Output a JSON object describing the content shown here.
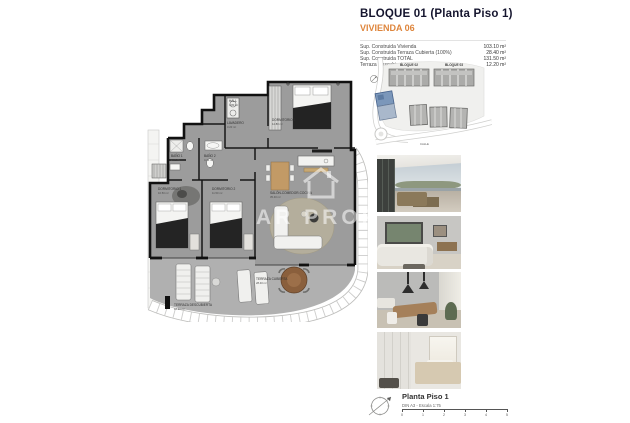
{
  "header": {
    "title": "BLOQUE 01  (Planta Piso 1)",
    "subtitle": "VIVIENDA 06",
    "specs": [
      {
        "label": "Sup. Construida Vivienda",
        "value": "103.10 m²"
      },
      {
        "label": "Sup. Construida Terraza Cubierta (100%)",
        "value": "28.40 m²"
      },
      {
        "label": "Sup. Construida TOTAL",
        "value": "131.50 m²"
      },
      {
        "label": "Terraza Descubierta",
        "value": "12.20 m²"
      }
    ]
  },
  "site_plan": {
    "block_labels": [
      "BLOQUE 02",
      "BLOQUE 03"
    ],
    "street_label": "CALLE",
    "highlight_color": "#7b97ba"
  },
  "plan": {
    "rooms": [
      {
        "name": "HALL",
        "area": "3.80 m²"
      },
      {
        "name": "LAVADERO",
        "area": "3.20 m²"
      },
      {
        "name": "BAÑO 1",
        "area": "4.05 m²"
      },
      {
        "name": "BAÑO 2",
        "area": "4.20 m²"
      },
      {
        "name": "DORMITORIO 1",
        "area": "10.50 m²"
      },
      {
        "name": "DORMITORIO 2",
        "area": "11.50 m²"
      },
      {
        "name": "DORMITORIO 3",
        "area": "12.80 m²"
      },
      {
        "name": "SALÓN-COMEDOR-COCINA",
        "area": "35.40 m²"
      },
      {
        "name": "TERRAZA CUBIERTA",
        "area": "28.40 m²"
      },
      {
        "name": "TERRAZA DESCUBIERTA",
        "area": "12.20 m²"
      }
    ],
    "watermark": "AR PROPERTIES",
    "watermark2": "S"
  },
  "footer": {
    "title": "Planta Piso 1",
    "scale_note": "DIN A3 - Escala 1:75",
    "scale_ticks": [
      "0",
      "1",
      "2",
      "3",
      "4",
      "5"
    ]
  },
  "colors": {
    "accent_orange": "#de853c",
    "title_dark": "#15152e",
    "plan_floor": "#9c9c9c",
    "terrace_floor": "#b0b0b0",
    "wall": "#141414"
  }
}
